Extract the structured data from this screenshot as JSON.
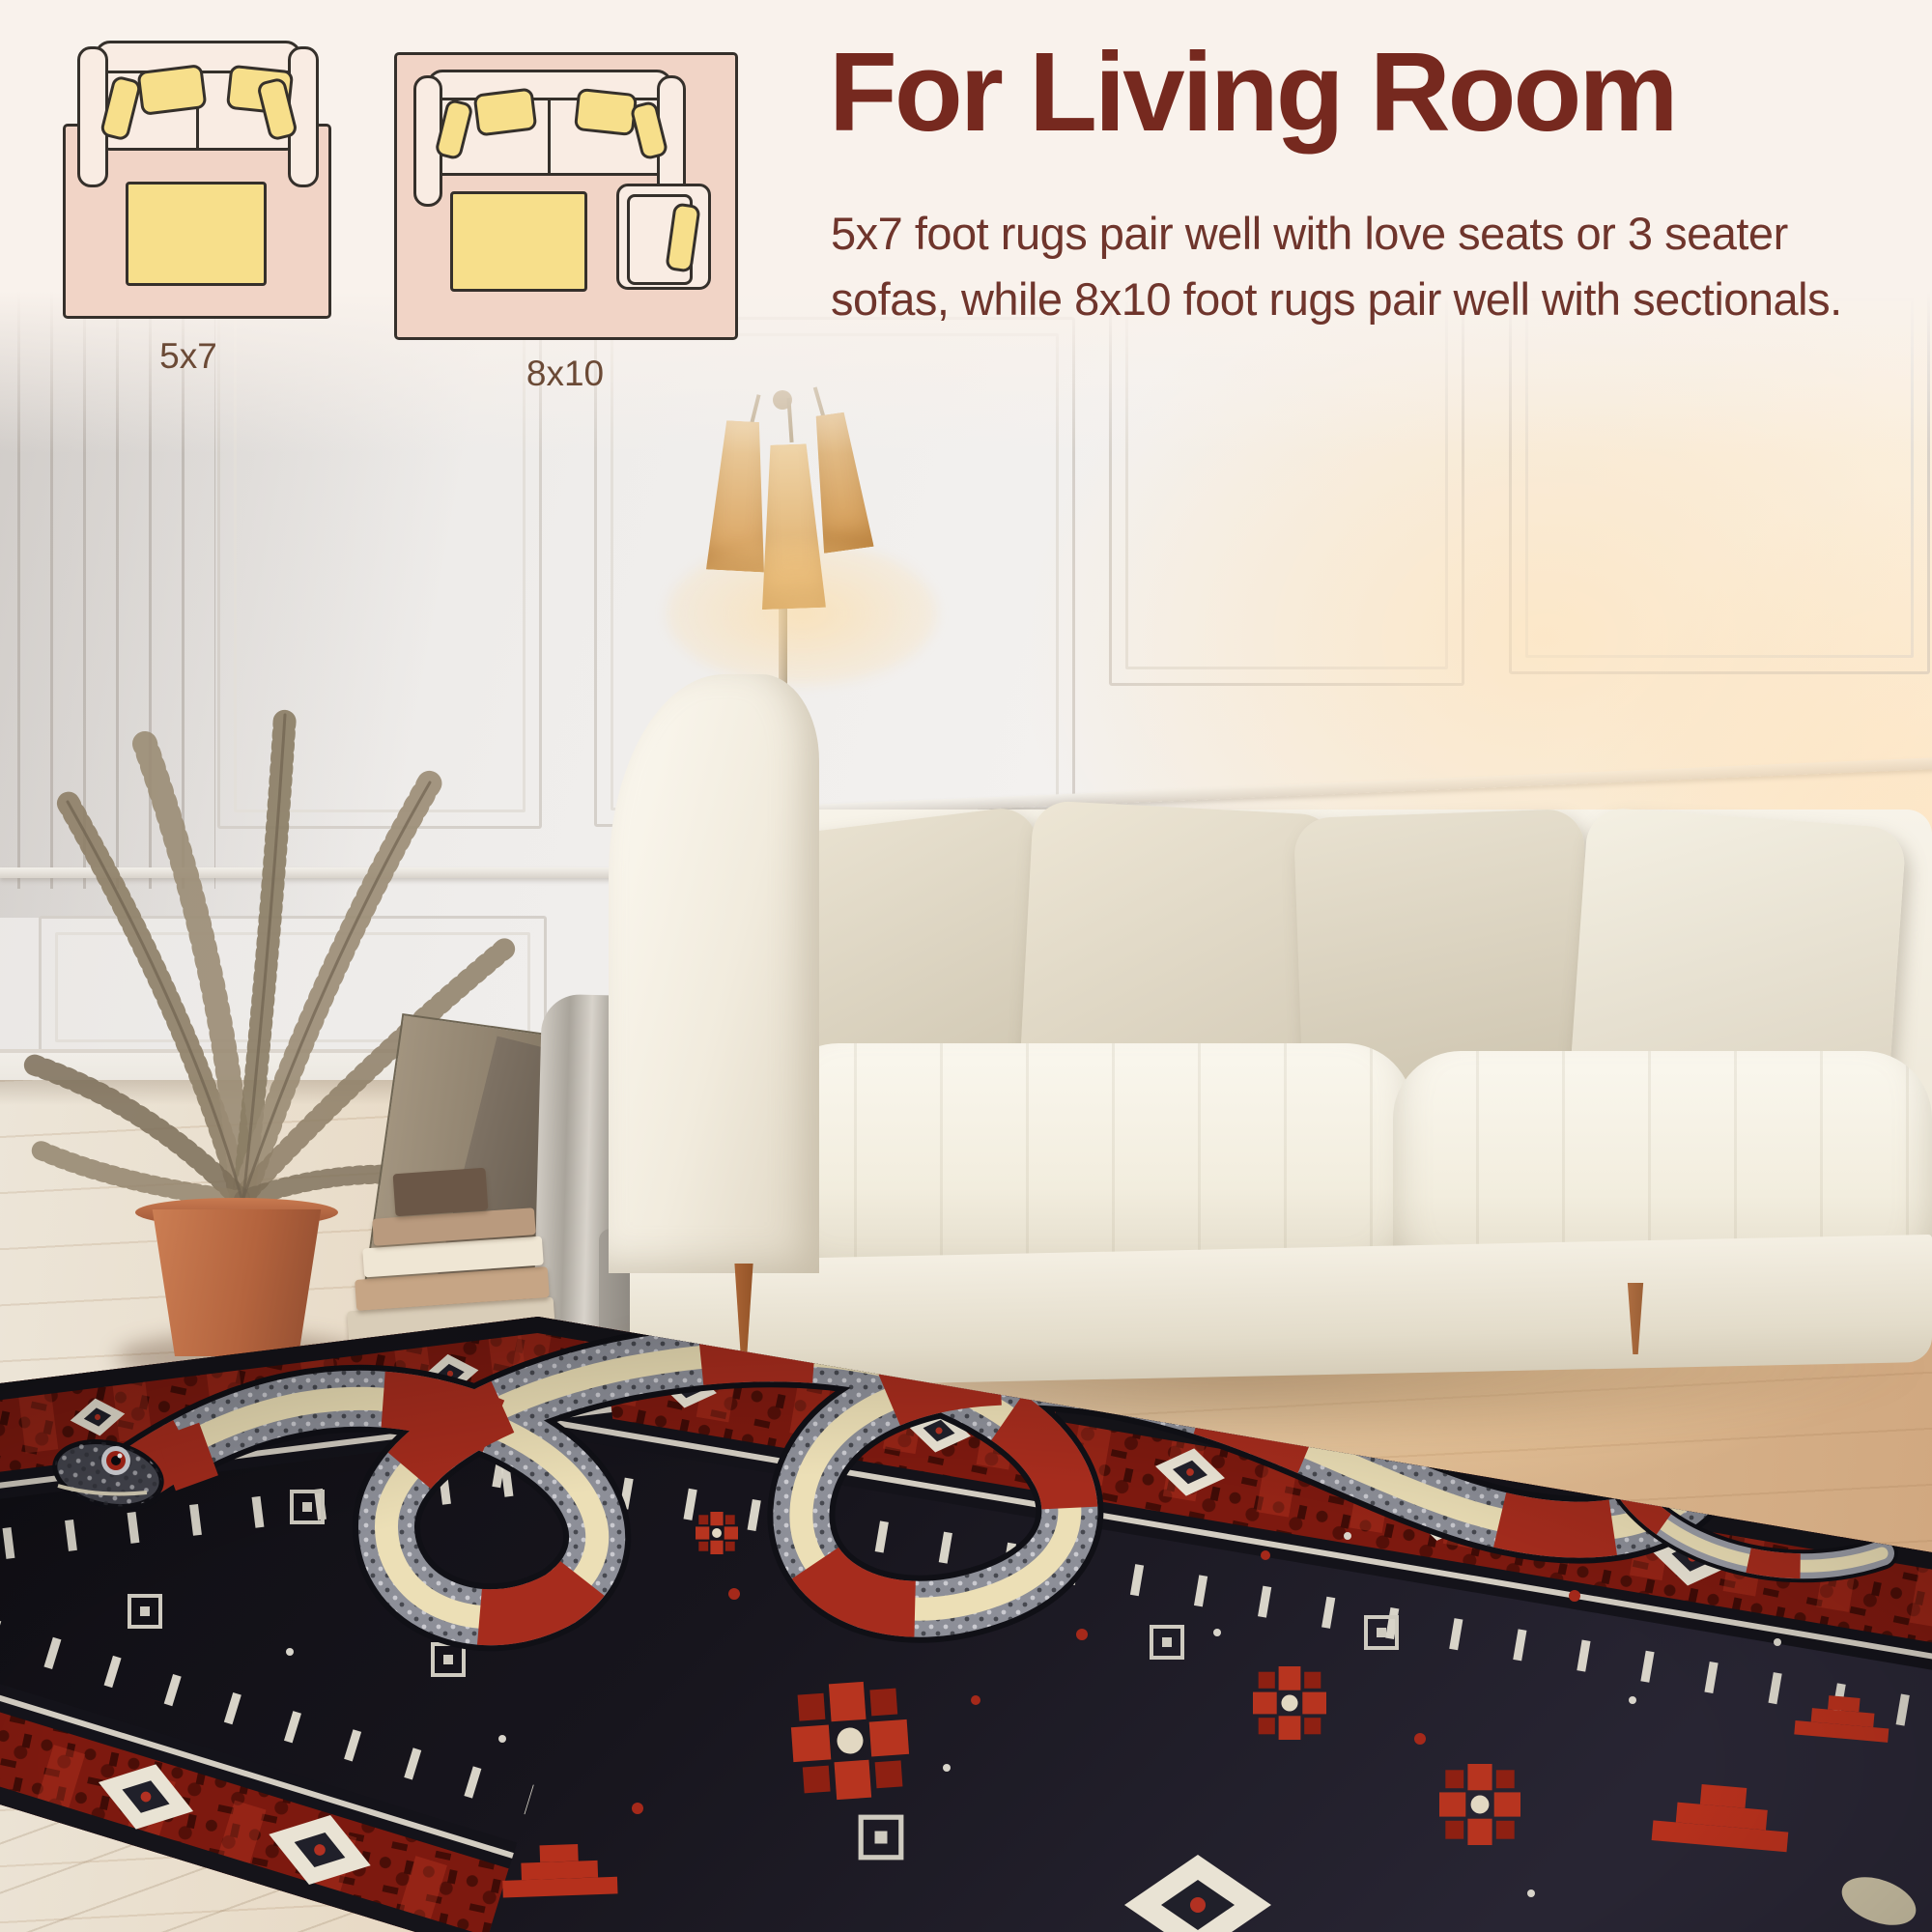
{
  "header": {
    "title": "For Living Room",
    "description_line1": "5x7 foot rugs pair well with love seats or 3 seater",
    "description_line2": "sofas, while 8x10 foot rugs pair well with sectionals.",
    "colors": {
      "background": "#f9f2ec",
      "title": "#76291f",
      "body_text": "#6f352c",
      "label": "#6b4a36"
    }
  },
  "diagrams": [
    {
      "label": "5x7",
      "items": [
        "sofa-top-view",
        "coffee-table",
        "rug"
      ]
    },
    {
      "label": "8x10",
      "items": [
        "sofa-top-view",
        "coffee-table",
        "armchair",
        "rug"
      ]
    }
  ],
  "diagram_colors": {
    "rug": "#f1d4c6",
    "furniture": "#f9ece3",
    "pillow": "#f7df8b",
    "outline": "#35302b"
  },
  "scene": {
    "objects": [
      "white-paneled-wall",
      "floor-lamp",
      "dried-palm-plant",
      "terracotta-pot",
      "stacked-books",
      "leaning-frames",
      "gray-drape",
      "gray-vase",
      "white-sofa",
      "beige-throw-pillows",
      "wood-floor",
      "black-snake-area-rug"
    ],
    "rug_colors": {
      "field": "#15141a",
      "border_red": "#7d190f",
      "accent_red": "#b93222",
      "cream": "#ead9ae",
      "gray": "#8f929b"
    }
  }
}
